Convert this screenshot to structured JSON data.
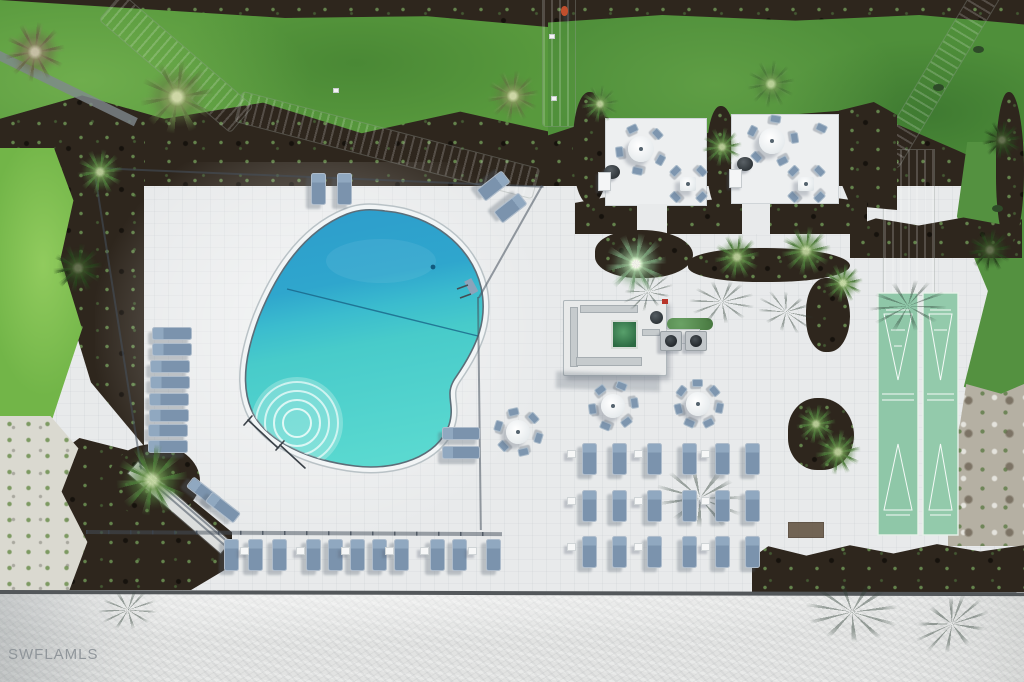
{
  "watermark": {
    "text": "SWFLAMLS"
  },
  "palette": {
    "deck": "#e8eaeb",
    "grass_bright": "#72b548",
    "grass_mid": "#58993d",
    "grass_dark": "#4f8f3a",
    "mulch": "#2e261d",
    "pool_deep": "#2d9dcc",
    "pool_shallow": "#5ad9d0",
    "coping": "#f2f5f6",
    "court_green": "#8fc7a8",
    "lounger_blue": "#7e96af",
    "sand": "#e2e3e2",
    "seawall": "#53575a",
    "person_shirt": "#c14f2d",
    "spa_water": "#2c6a42"
  },
  "scene": {
    "fences": [
      {
        "x": 95,
        "y": 167,
        "len": 449,
        "rot": 2.4
      },
      {
        "x": 543,
        "y": 186,
        "len": 129,
        "rot": 119.4
      },
      {
        "x": 479,
        "y": 297,
        "len": 233,
        "rot": 89.3
      },
      {
        "x": 95,
        "y": 168,
        "len": 305,
        "rot": 81.1
      },
      {
        "x": 140,
        "y": 465,
        "len": 127,
        "rot": 40.8
      },
      {
        "x": 146,
        "y": 476,
        "len": 122,
        "rot": 40.8
      },
      {
        "x": 86,
        "y": 530,
        "len": 416,
        "rot": 0.3,
        "cls": "rail"
      },
      {
        "x": 0,
        "y": 590,
        "len": 1026,
        "rot": 0.12,
        "cls": "wall",
        "n": "sea-wall"
      }
    ],
    "rect_shadows": [
      {
        "x": 556,
        "y": 373,
        "w": 104,
        "h": 17,
        "rot": 2
      }
    ],
    "palm_shadows": [
      {
        "x": 722,
        "y": 302,
        "s": 62,
        "rot": 15
      },
      {
        "x": 786,
        "y": 312,
        "s": 56,
        "rot": 40
      },
      {
        "x": 908,
        "y": 306,
        "s": 74,
        "rot": 8
      },
      {
        "x": 700,
        "y": 498,
        "s": 84,
        "rot": 28
      },
      {
        "x": 648,
        "y": 292,
        "s": 50,
        "rot": -10
      },
      {
        "x": 852,
        "y": 612,
        "s": 88,
        "rot": 22
      },
      {
        "x": 952,
        "y": 624,
        "s": 74,
        "rot": -12
      },
      {
        "x": 128,
        "y": 610,
        "s": 56,
        "rot": 10
      }
    ],
    "loungers": [
      {
        "x": 311,
        "y": 173
      },
      {
        "x": 337,
        "y": 173
      },
      {
        "x": 486,
        "y": 170,
        "rot": 52
      },
      {
        "x": 503,
        "y": 192,
        "rot": 52
      },
      {
        "x": 224,
        "y": 539
      },
      {
        "x": 248,
        "y": 539
      },
      {
        "x": 272,
        "y": 539
      },
      {
        "x": 306,
        "y": 539
      },
      {
        "x": 328,
        "y": 539
      },
      {
        "x": 350,
        "y": 539
      },
      {
        "x": 372,
        "y": 539
      },
      {
        "x": 394,
        "y": 539
      },
      {
        "x": 430,
        "y": 539
      },
      {
        "x": 452,
        "y": 539
      },
      {
        "x": 486,
        "y": 539
      },
      {
        "x": 582,
        "y": 443
      },
      {
        "x": 612,
        "y": 443
      },
      {
        "x": 647,
        "y": 443
      },
      {
        "x": 682,
        "y": 443
      },
      {
        "x": 715,
        "y": 443
      },
      {
        "x": 745,
        "y": 443
      },
      {
        "x": 582,
        "y": 490
      },
      {
        "x": 612,
        "y": 490
      },
      {
        "x": 647,
        "y": 490
      },
      {
        "x": 682,
        "y": 490
      },
      {
        "x": 715,
        "y": 490
      },
      {
        "x": 745,
        "y": 490
      },
      {
        "x": 582,
        "y": 536
      },
      {
        "x": 612,
        "y": 536
      },
      {
        "x": 647,
        "y": 536
      },
      {
        "x": 682,
        "y": 536
      },
      {
        "x": 715,
        "y": 536
      },
      {
        "x": 745,
        "y": 536
      },
      {
        "x": 152,
        "y": 327,
        "o": "h"
      },
      {
        "x": 152,
        "y": 343,
        "o": "h"
      },
      {
        "x": 150,
        "y": 360,
        "o": "h"
      },
      {
        "x": 150,
        "y": 376,
        "o": "h"
      },
      {
        "x": 149,
        "y": 393,
        "o": "h"
      },
      {
        "x": 149,
        "y": 409,
        "o": "h"
      },
      {
        "x": 148,
        "y": 424,
        "o": "h"
      },
      {
        "x": 148,
        "y": 440,
        "o": "h"
      },
      {
        "x": 442,
        "y": 427,
        "o": "h",
        "w": 38
      },
      {
        "x": 442,
        "y": 446,
        "o": "h",
        "w": 38
      },
      {
        "x": 186,
        "y": 486,
        "o": "h",
        "w": 36,
        "rot": 38
      },
      {
        "x": 205,
        "y": 501,
        "o": "h",
        "w": 36,
        "rot": 38
      }
    ],
    "side_tables": [
      {
        "x": 567,
        "y": 450
      },
      {
        "x": 634,
        "y": 450
      },
      {
        "x": 701,
        "y": 450
      },
      {
        "x": 567,
        "y": 497
      },
      {
        "x": 634,
        "y": 497
      },
      {
        "x": 701,
        "y": 497
      },
      {
        "x": 567,
        "y": 543
      },
      {
        "x": 634,
        "y": 543
      },
      {
        "x": 701,
        "y": 543
      },
      {
        "x": 240,
        "y": 547
      },
      {
        "x": 296,
        "y": 547
      },
      {
        "x": 341,
        "y": 547
      },
      {
        "x": 385,
        "y": 547
      },
      {
        "x": 420,
        "y": 547
      },
      {
        "x": 468,
        "y": 547
      }
    ],
    "umbrella_sets": [
      {
        "x": 518,
        "y": 432,
        "chairs": 6,
        "off": 0.3
      },
      {
        "x": 613,
        "y": 406,
        "chairs": 6,
        "off": 0.9
      },
      {
        "x": 698,
        "y": 404,
        "chairs": 7,
        "off": 0.2
      }
    ],
    "patio_round_sets": [
      {
        "x": 641,
        "y": 149,
        "chairs": 5,
        "off": 0.5
      },
      {
        "x": 772,
        "y": 141,
        "chairs": 5,
        "off": 1.1
      }
    ],
    "square_sets": [
      {
        "x": 688,
        "y": 184
      },
      {
        "x": 806,
        "y": 184
      }
    ],
    "bbq_grills": [
      {
        "x": 612,
        "y": 172
      },
      {
        "x": 745,
        "y": 164
      }
    ],
    "grill_stations": [
      {
        "x": 671,
        "y": 341
      },
      {
        "x": 696,
        "y": 341
      }
    ],
    "carts": [
      {
        "x": 604,
        "y": 181
      },
      {
        "x": 735,
        "y": 178
      }
    ],
    "extra_chairs": [
      {
        "x": 816,
        "y": 124,
        "rot": 25
      }
    ],
    "palms": [
      {
        "x": 177,
        "y": 97,
        "s": 74,
        "v": "mix"
      },
      {
        "x": 100,
        "y": 172,
        "s": 46,
        "v": "green"
      },
      {
        "x": 35,
        "y": 52,
        "s": 60,
        "v": "brown"
      },
      {
        "x": 78,
        "y": 268,
        "s": 50,
        "v": "dark"
      },
      {
        "x": 152,
        "y": 480,
        "s": 72,
        "v": "green"
      },
      {
        "x": 513,
        "y": 96,
        "s": 52,
        "v": "mix"
      },
      {
        "x": 600,
        "y": 104,
        "s": 38,
        "v": "green"
      },
      {
        "x": 771,
        "y": 84,
        "s": 48,
        "v": "green"
      },
      {
        "x": 722,
        "y": 147,
        "s": 40,
        "v": "green"
      },
      {
        "x": 636,
        "y": 264,
        "s": 62,
        "v": "pale"
      },
      {
        "x": 737,
        "y": 257,
        "s": 46,
        "v": "green"
      },
      {
        "x": 806,
        "y": 251,
        "s": 50,
        "v": "green"
      },
      {
        "x": 843,
        "y": 283,
        "s": 40,
        "v": "green"
      },
      {
        "x": 816,
        "y": 424,
        "s": 40,
        "v": "green"
      },
      {
        "x": 838,
        "y": 452,
        "s": 46,
        "v": "green"
      },
      {
        "x": 990,
        "y": 250,
        "s": 44,
        "v": "dark"
      },
      {
        "x": 1002,
        "y": 140,
        "s": 40,
        "v": "dark"
      }
    ],
    "person": {
      "x": 561,
      "y": 6
    },
    "red_items": [
      {
        "x": 662,
        "y": 299
      }
    ],
    "mats": [
      {
        "x": 788,
        "y": 522,
        "w": 36,
        "h": 16
      }
    ],
    "shrubs": [
      {
        "x": 933,
        "y": 84
      },
      {
        "x": 973,
        "y": 46
      },
      {
        "x": 992,
        "y": 205
      }
    ],
    "path_objects": [
      {
        "x": 549,
        "y": 34
      },
      {
        "x": 551,
        "y": 96
      },
      {
        "x": 333,
        "y": 88
      }
    ]
  }
}
